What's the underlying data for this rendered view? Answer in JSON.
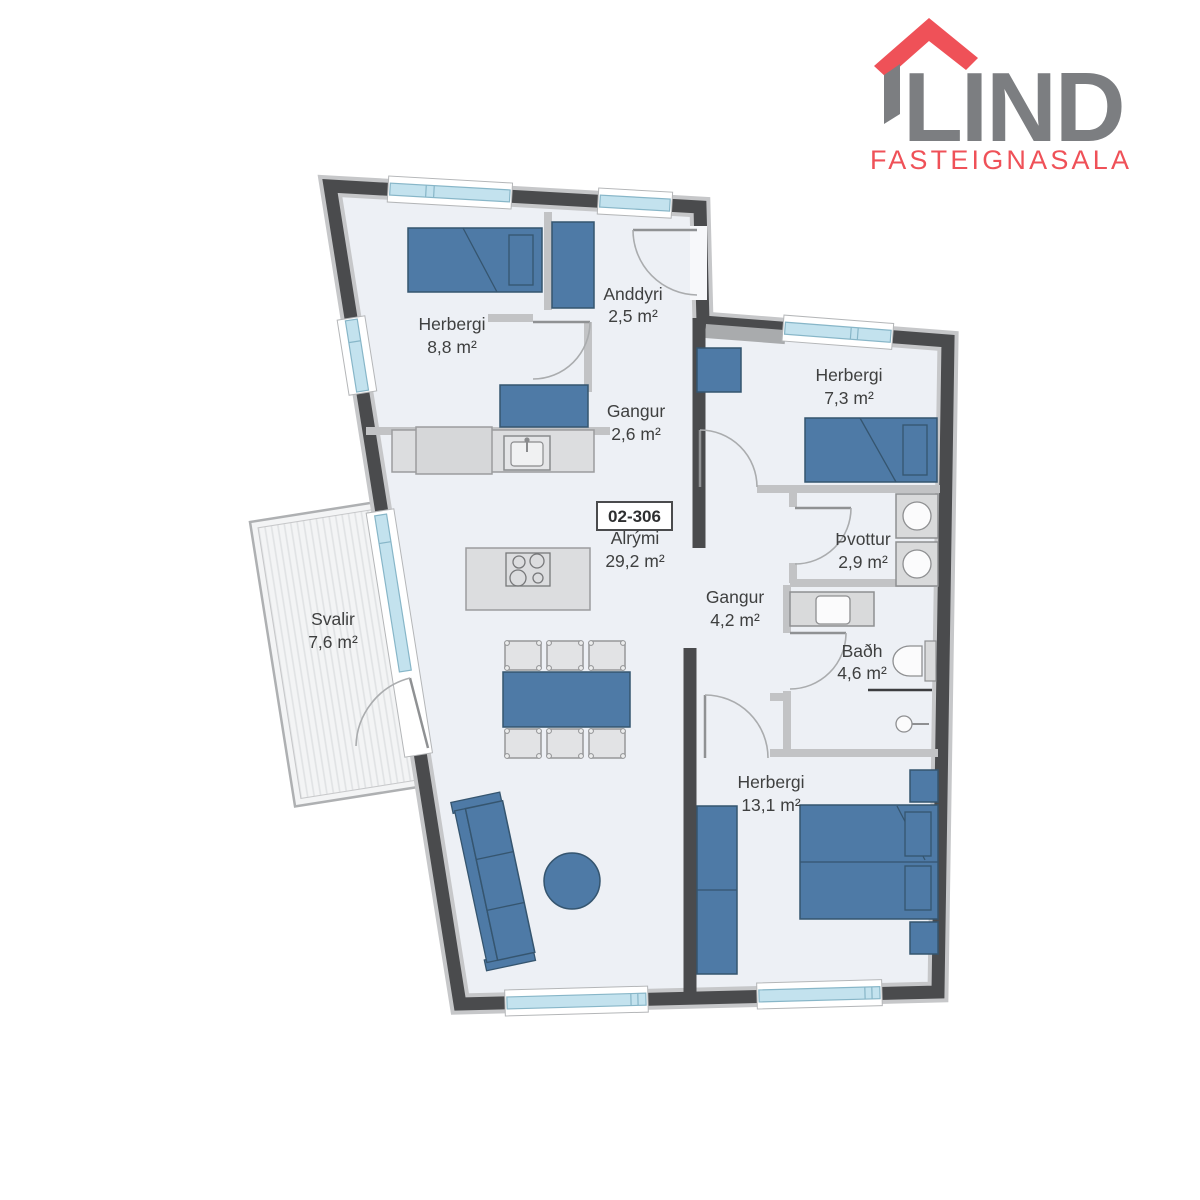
{
  "logo": {
    "brand": "LIND",
    "tagline": "FASTEIGNASALA",
    "roof_color": "#ef5158",
    "brand_color": "#7c7e81"
  },
  "unit": {
    "number": "02-306"
  },
  "rooms": [
    {
      "id": "herbergi-1",
      "name": "Herbergi",
      "area": "8,8 m²"
    },
    {
      "id": "anddyri",
      "name": "Anddyri",
      "area": "2,5 m²"
    },
    {
      "id": "gangur-1",
      "name": "Gangur",
      "area": "2,6 m²"
    },
    {
      "id": "herbergi-2",
      "name": "Herbergi",
      "area": "7,3 m²"
    },
    {
      "id": "alrymi",
      "name": "Alrými",
      "area": "29,2 m²"
    },
    {
      "id": "gangur-2",
      "name": "Gangur",
      "area": "4,2 m²"
    },
    {
      "id": "thvottur",
      "name": "Þvottur",
      "area": "2,9 m²"
    },
    {
      "id": "badh",
      "name": "Baðh",
      "area": "4,6 m²"
    },
    {
      "id": "svalir",
      "name": "Svalir",
      "area": "7,6 m²"
    },
    {
      "id": "herbergi-3",
      "name": "Herbergi",
      "area": "13,1 m²"
    }
  ],
  "colors": {
    "wall_dark": "#4a4b4d",
    "wall_light": "#c6c7c9",
    "floor": "#edf0f5",
    "furniture_blue": "#4e7aa6",
    "furniture_gray": "#dcdddf",
    "window_glass": "#c3e2ee",
    "balcony_deck": "#f3f4f5",
    "label_text": "#3f4040"
  },
  "furniture": [
    "single-bed",
    "wardrobe",
    "closet",
    "kitchen-counter",
    "fridge",
    "sink",
    "kitchen-island",
    "cooktop",
    "dining-table",
    "chair",
    "sofa",
    "coffee-table",
    "double-bed",
    "nightstand",
    "washer",
    "dryer",
    "bathroom-vanity",
    "toilet",
    "shower"
  ]
}
